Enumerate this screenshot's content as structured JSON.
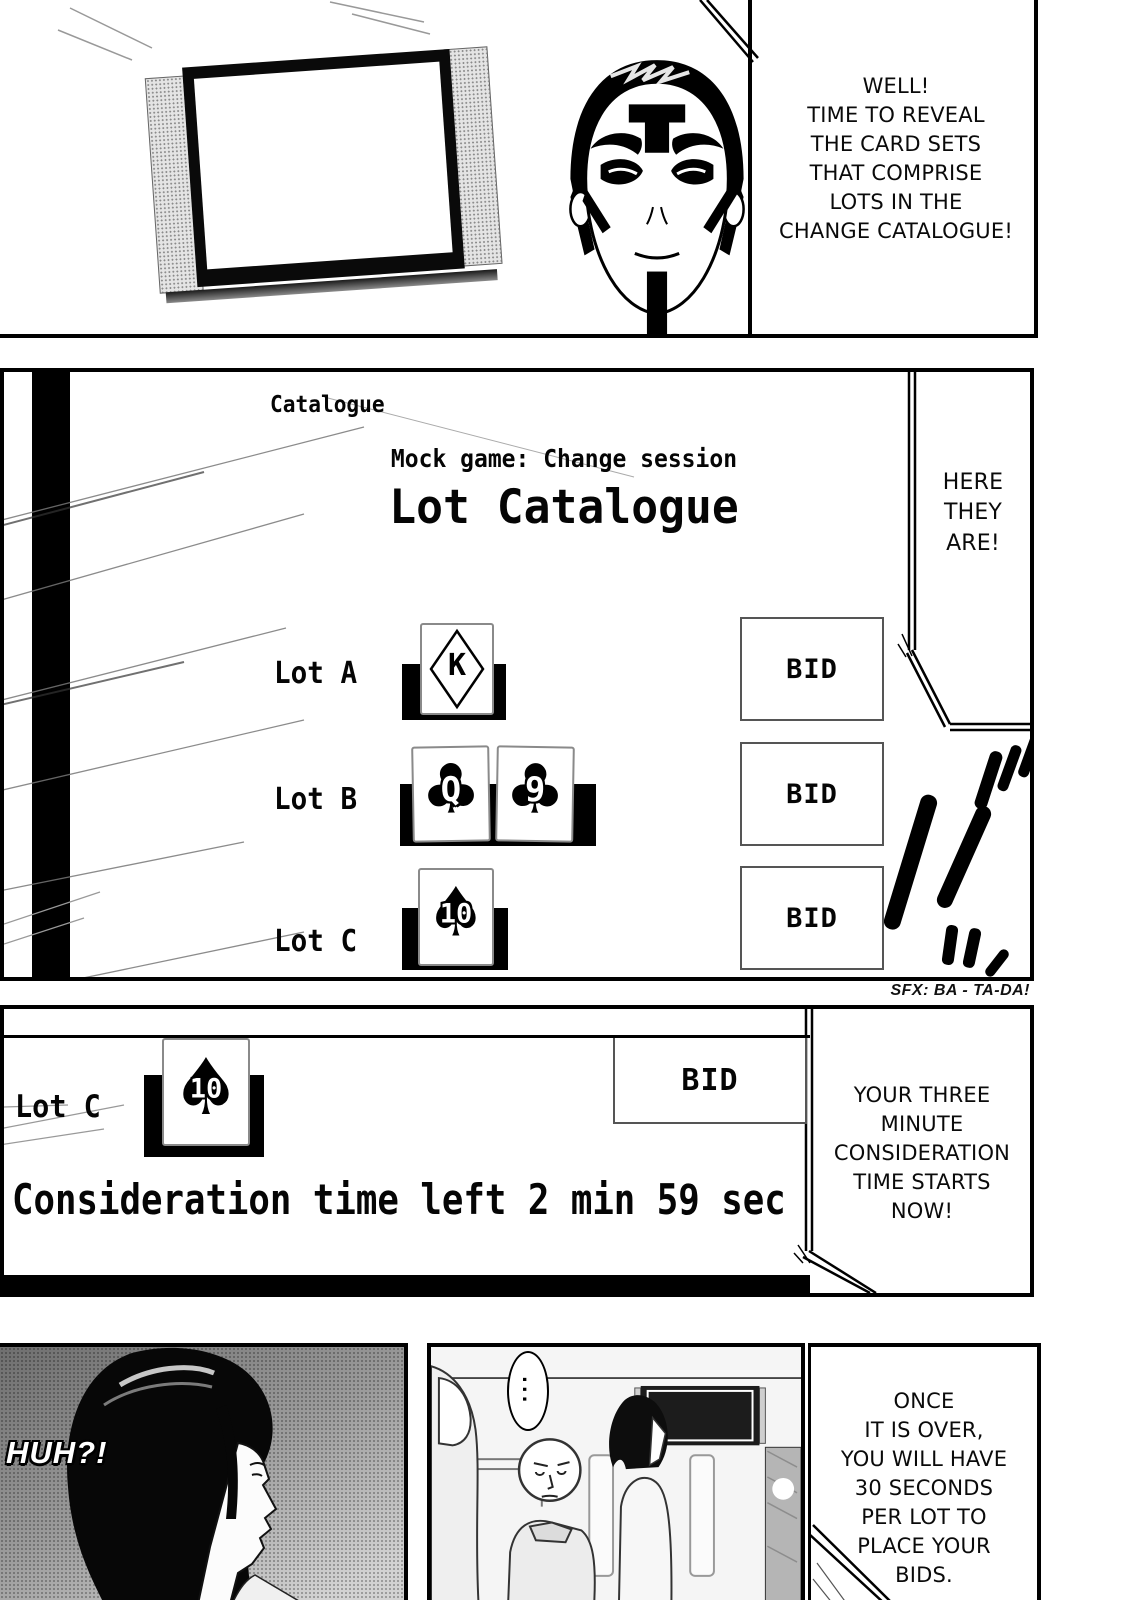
{
  "panel1": {
    "speech": "WELL!\nTIME TO REVEAL\nTHE CARD SETS\nTHAT COMPRISE\nLOTS IN THE\nCHANGE CATALOGUE!"
  },
  "catalogue_screen": {
    "corner_label": "Catalogue",
    "subtitle": "Mock game: Change session",
    "title": "Lot Catalogue",
    "bid_label": "BID",
    "lots": [
      {
        "label": "Lot A",
        "cards": [
          {
            "rank": "K",
            "suit": "diamond"
          }
        ]
      },
      {
        "label": "Lot B",
        "cards": [
          {
            "rank": "Q",
            "suit": "club",
            "glyph": "♣"
          },
          {
            "rank": "9",
            "suit": "club",
            "glyph": "♣"
          }
        ]
      },
      {
        "label": "Lot C",
        "cards": [
          {
            "rank": "10",
            "suit": "spade",
            "glyph": "♠"
          }
        ]
      }
    ],
    "speech": "HERE\nTHEY\nARE!"
  },
  "sfx": {
    "caption": "SFX: BA - TA-DA!",
    "katakana": "バ"
  },
  "panel3": {
    "lot_label": "Lot C",
    "card": {
      "rank": "10",
      "suit": "spade",
      "glyph": "♠"
    },
    "bid_label": "BID",
    "timer": "Consideration time left 2 min 59 sec",
    "speech": "YOUR THREE\nMINUTE\nCONSIDERATION\nTIME STARTS\nNOW!"
  },
  "panel4": {
    "left_speech": "HUH?!",
    "middle_speech": "...",
    "right_speech": "ONCE\nIT IS OVER,\nYOU WILL HAVE\n30 SECONDS\nPER LOT TO\nPLACE YOUR\nBIDS."
  }
}
